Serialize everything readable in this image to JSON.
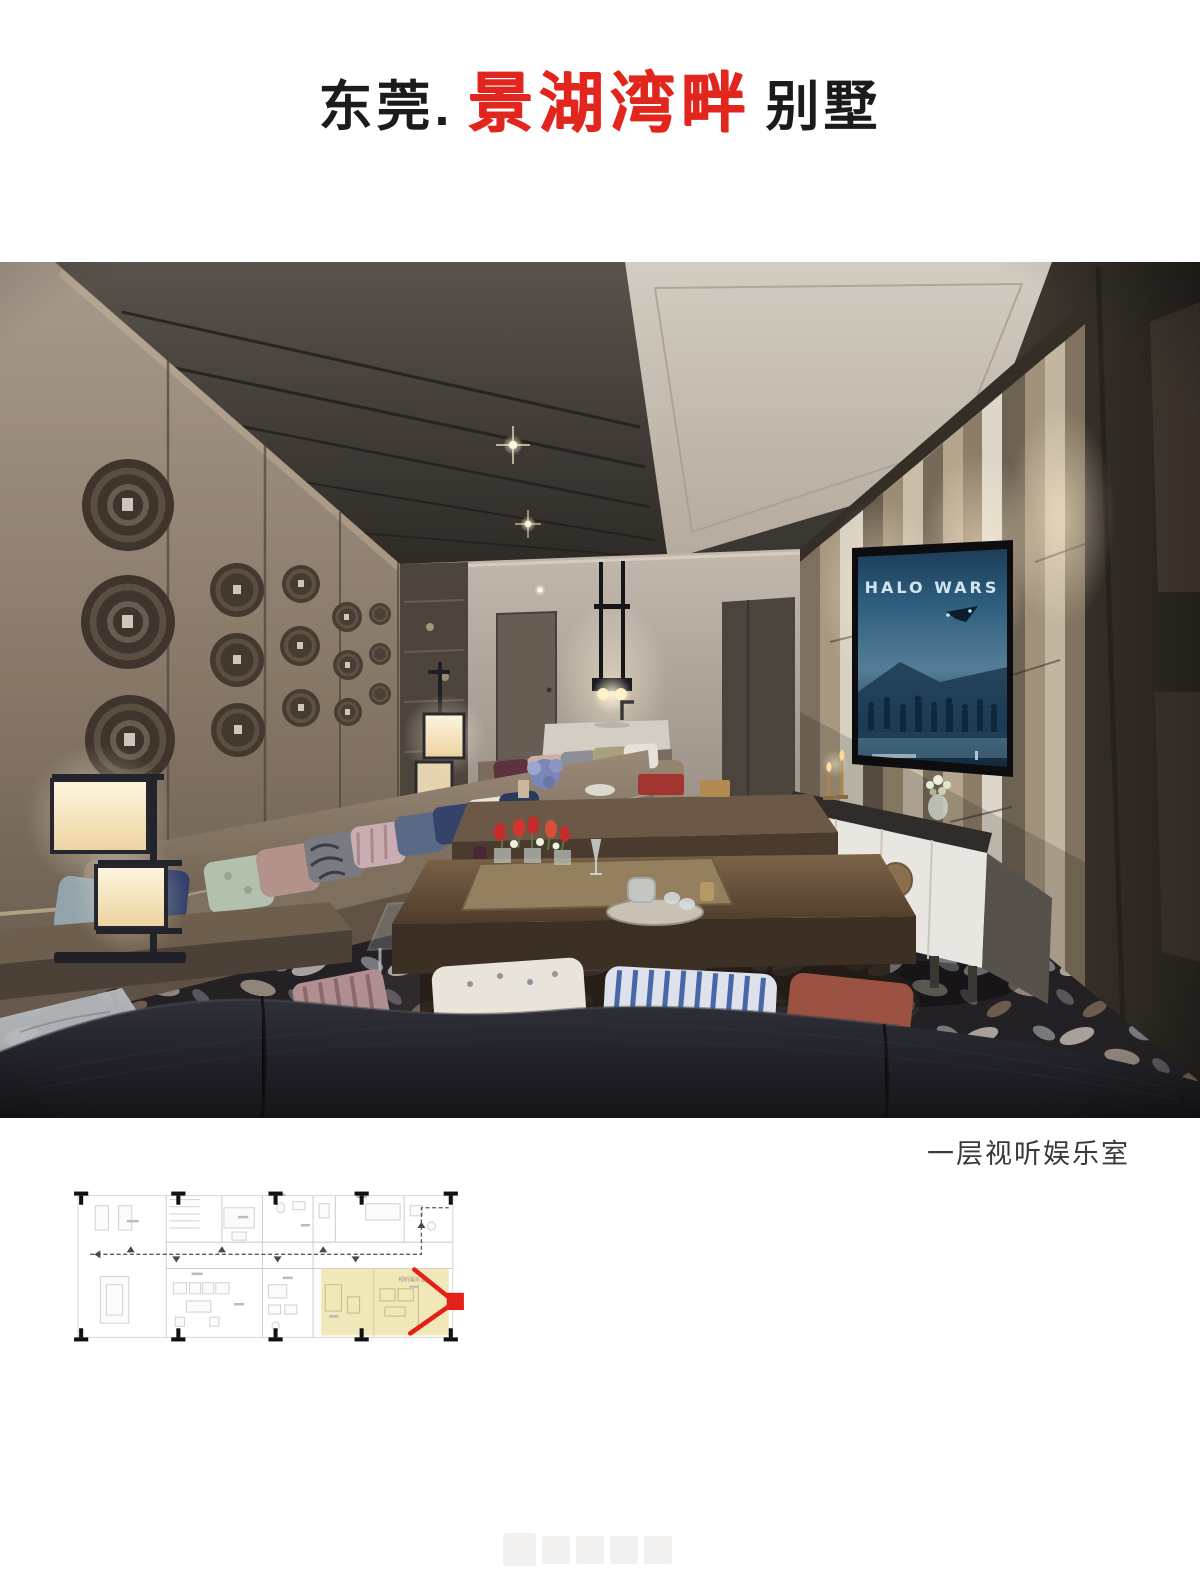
{
  "title": {
    "prefix": "东莞.",
    "highlight": "景湖湾畔",
    "suffix": "别墅",
    "highlight_color": "#e3261d"
  },
  "photo": {
    "caption": "一层视听娱乐室",
    "tv_title": "HALO WARS",
    "scene": "home theater lounge rendering",
    "accent_colors": {
      "wall_taupe": "#877767",
      "lamp_glow": "#f7ecd2",
      "carpet_dark": "#2c292c",
      "cabinet_white": "#e9e6e1"
    }
  },
  "floor_plan": {
    "room_label": "视听娱乐室",
    "highlight_color": "#eee3ab",
    "camera_marker_color": "#e32119"
  }
}
